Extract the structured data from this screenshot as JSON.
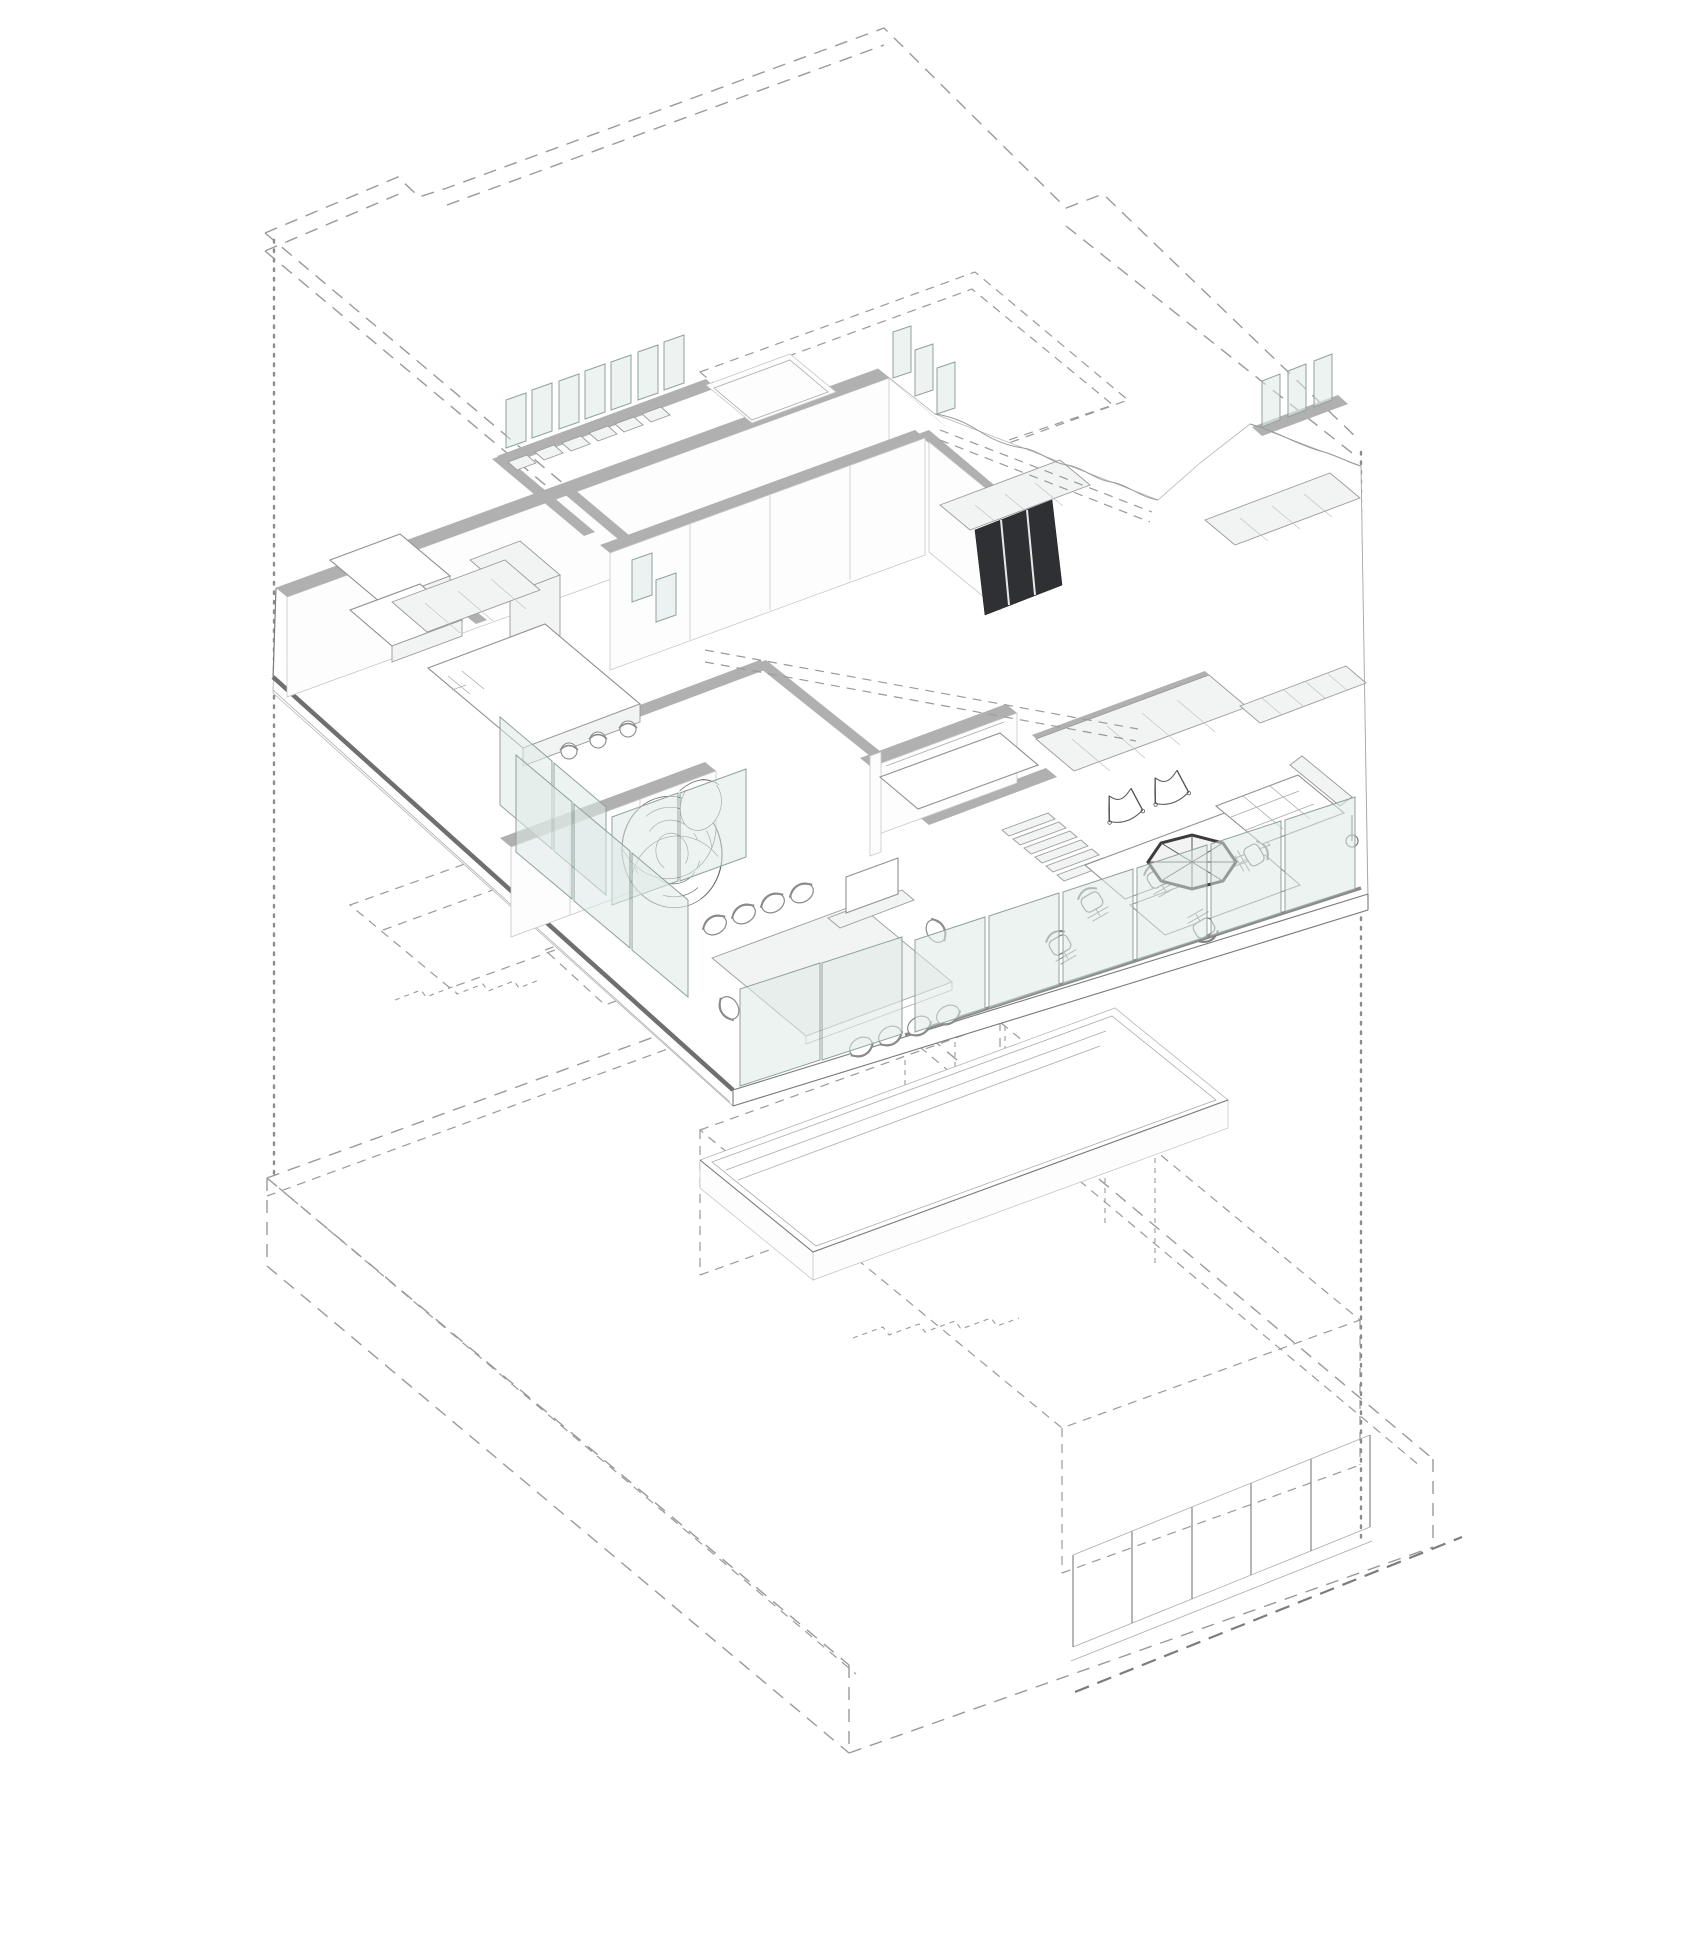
{
  "page": {
    "title": "Exploded axonometric floor plan",
    "description": "Line drawing: detailed office floor level shown solid, upper roof level and lower levels shown as dashed outlines, no text labels visible"
  },
  "drawing": {
    "type": "exploded-axonometric-architectural-diagram",
    "levels": [
      {
        "id": "roof",
        "name": "upper-level-outline",
        "style": "dashed",
        "features": [
          "footprint outline with stepped notches",
          "roof opening",
          "slab thickness double lines"
        ]
      },
      {
        "id": "main",
        "name": "main-office-floor",
        "style": "solid",
        "features": [
          "grey wall poche",
          "glass partitions",
          "glass balustrade",
          "furniture",
          "terrace"
        ]
      },
      {
        "id": "lower",
        "name": "lower-levels-outline",
        "style": "dashed",
        "features": [
          "two stacked dashed volumes",
          "dashed stairs",
          "glazed facade slab edge"
        ]
      }
    ],
    "section_cuts": [
      {
        "id": "left-cut",
        "style": "dotted-vertical"
      },
      {
        "id": "right-cut",
        "style": "dotted-vertical"
      }
    ],
    "rooms": [
      {
        "name": "changing-rooms",
        "furniture": [
          "L-bench",
          "bench",
          "closet"
        ]
      },
      {
        "name": "shelf-room",
        "furniture": [
          "glass-fin-partitions",
          "wall-shelves"
        ]
      },
      {
        "name": "entry-porch",
        "furniture": [
          "canopy-slab"
        ]
      },
      {
        "name": "kitchen",
        "furniture": [
          "island-counter",
          "back-counter",
          "bar-stools"
        ]
      },
      {
        "name": "quiet-room",
        "furniture": [
          "wireframe-mesh-chair",
          "glass-partitions"
        ]
      },
      {
        "name": "conference-room",
        "furniture": [
          "long-table",
          "ten-chairs",
          "media-console",
          "glass-walls"
        ]
      },
      {
        "name": "core",
        "furniture": [
          "banquette-booth",
          "stair"
        ]
      },
      {
        "name": "open-office",
        "furniture": [
          "two-desks",
          "task-chairs",
          "storage-wall"
        ]
      },
      {
        "name": "lounge",
        "furniture": [
          "sling-chairs",
          "octagonal-table",
          "tufted-sofa",
          "bookshelf",
          "floor-lamp"
        ]
      },
      {
        "name": "louver-room",
        "furniture": [
          "dark-louver-panel",
          "cabinets"
        ]
      }
    ],
    "counts": {
      "conference_chairs": 10,
      "bar_stools": 3,
      "task_chairs": 5,
      "sling_chairs": 2,
      "glass_fins_top_row": 7,
      "balustrade_panels": 6
    }
  },
  "colors": {
    "background": "#ffffff",
    "wall": "#b0b0b0",
    "wall_face": "#fdfdfe",
    "furniture": "#f2f3f3",
    "glass": "#dfeae6",
    "glass_frame": "#8fa29c",
    "dark_panel": "#2f3033",
    "dashed": "#9a9a9a",
    "dotted": "#8c8c8c",
    "slab_edge": "#6f6f6f"
  }
}
